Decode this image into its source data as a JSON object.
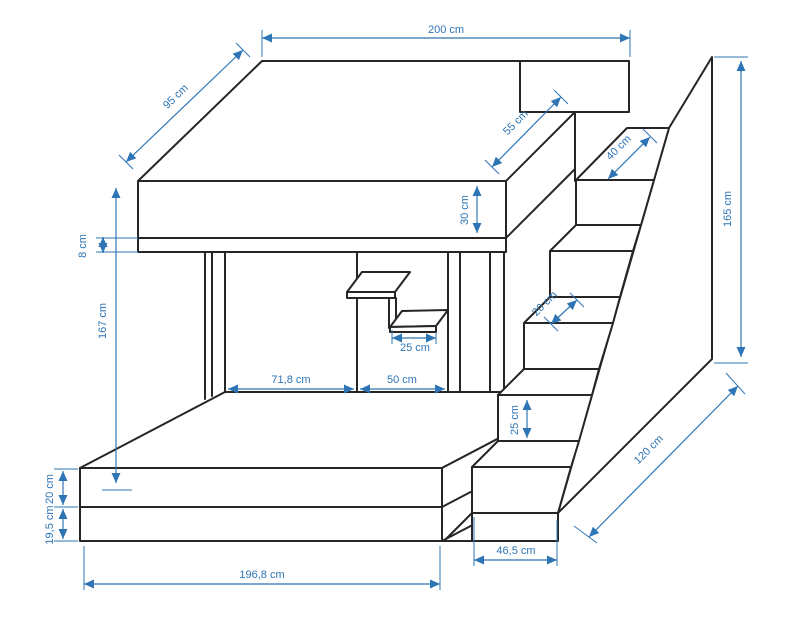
{
  "diagram": {
    "subject": "loft-bunk-bed-with-stairs-technical-drawing",
    "line_color": "#262626",
    "dimension_color": "#2e75b5",
    "dimensions": {
      "top_width": "200 cm",
      "top_depth": "95 cm",
      "top_right_edge": "55 cm",
      "landing_depth": "40 cm",
      "mattress_height": "30 cm",
      "rail_height": "8 cm",
      "clearance_height": "167 cm",
      "panel_left_width": "71,8 cm",
      "panel_right_width": "50 cm",
      "shelf_width": "25 cm",
      "tread_depth": "20 cm",
      "riser_height": "25 cm",
      "total_height": "165 cm",
      "stair_diagonal": "120 cm",
      "stair_width": "46,5 cm",
      "bed_length": "196,8 cm",
      "bed_upper_height": "20 cm",
      "bed_lower_height": "19,5 cm"
    }
  }
}
